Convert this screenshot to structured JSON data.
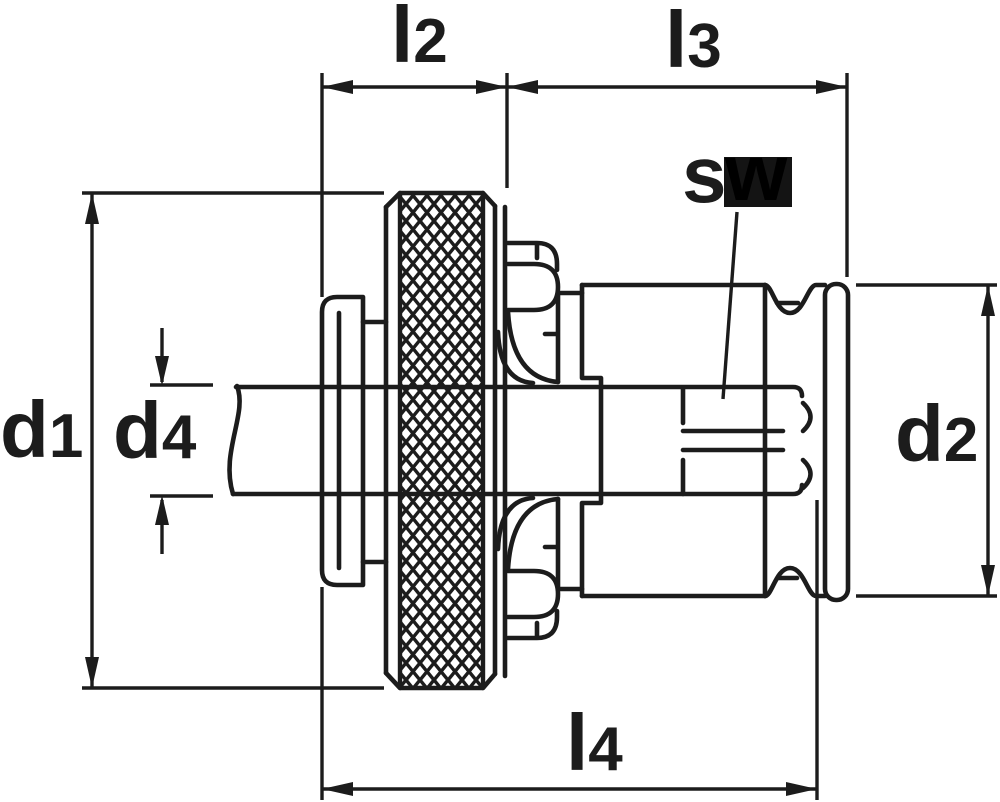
{
  "figure": {
    "kind": "technical-dimension-drawing",
    "subject": "quick-change tap adapter cross-section with knurled clamping ring",
    "background": "#ffffff",
    "line_color": "#1c1c1c",
    "highlight_color": "#141414"
  },
  "labels": {
    "l2": {
      "base": "l",
      "sub": "2"
    },
    "l3": {
      "base": "l",
      "sub": "3"
    },
    "l4": {
      "base": "l",
      "sub": "4"
    },
    "d1": {
      "base": "d",
      "sub": "1"
    },
    "d2": {
      "base": "d",
      "sub": "2"
    },
    "d4": {
      "base": "d",
      "sub": "4"
    },
    "sw": {
      "s": "s",
      "w": "w"
    }
  }
}
